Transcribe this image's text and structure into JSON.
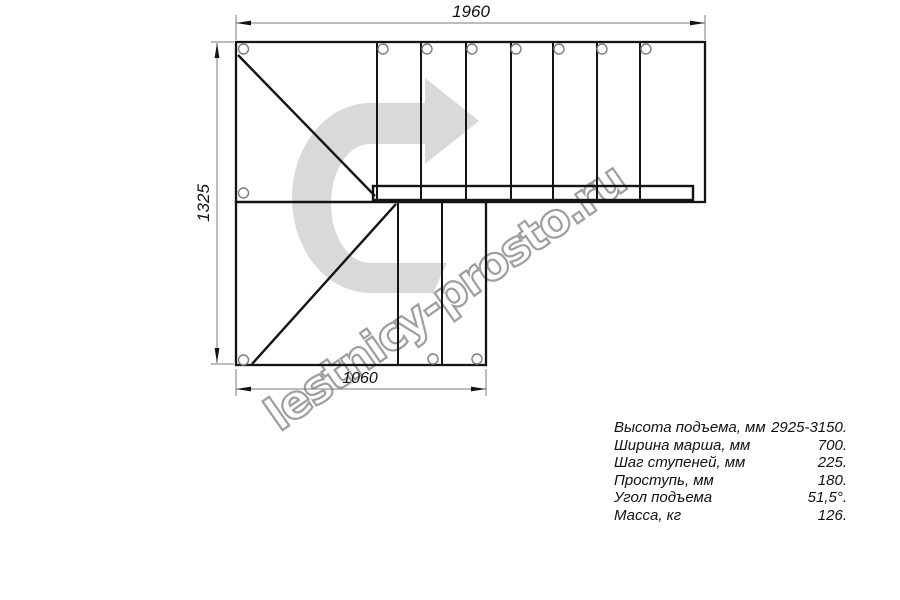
{
  "diagram": {
    "type": "staircase-plan-top-view",
    "description": "Plan drawing of an L-shaped (90-degree turn) staircase with two flights, landing squares with diagonal braces, stringer bar, mounting holes and turn-direction arrow watermark",
    "upper_flight_step_dividers": 7,
    "lower_flight_step_dividers": 2,
    "mounting_holes_upper": 9,
    "mounting_holes_lower": 3
  },
  "dimensions": {
    "top": {
      "value": "1960"
    },
    "left": {
      "value": "1325"
    },
    "bottom": {
      "value": "1060"
    }
  },
  "watermark": {
    "text": "lestnicy-prosto.ru"
  },
  "specs": {
    "rows": [
      {
        "label": "Высота подъема, мм",
        "value": "2925-3150."
      },
      {
        "label": "Ширина марша, мм",
        "value": "700."
      },
      {
        "label": "Шаг ступеней, мм",
        "value": "225."
      },
      {
        "label": "Проступь, мм",
        "value": "180."
      },
      {
        "label": "Угол подъема",
        "value": "51,5°."
      },
      {
        "label": "Масса, кг",
        "value": "126."
      }
    ]
  },
  "colors": {
    "line": "#141414",
    "dimension_line": "#7a7a7a",
    "hole_outline": "#7d7d7d",
    "watermark_fill": "#d9d9d9",
    "watermark_outline": "#9e9e9e"
  }
}
